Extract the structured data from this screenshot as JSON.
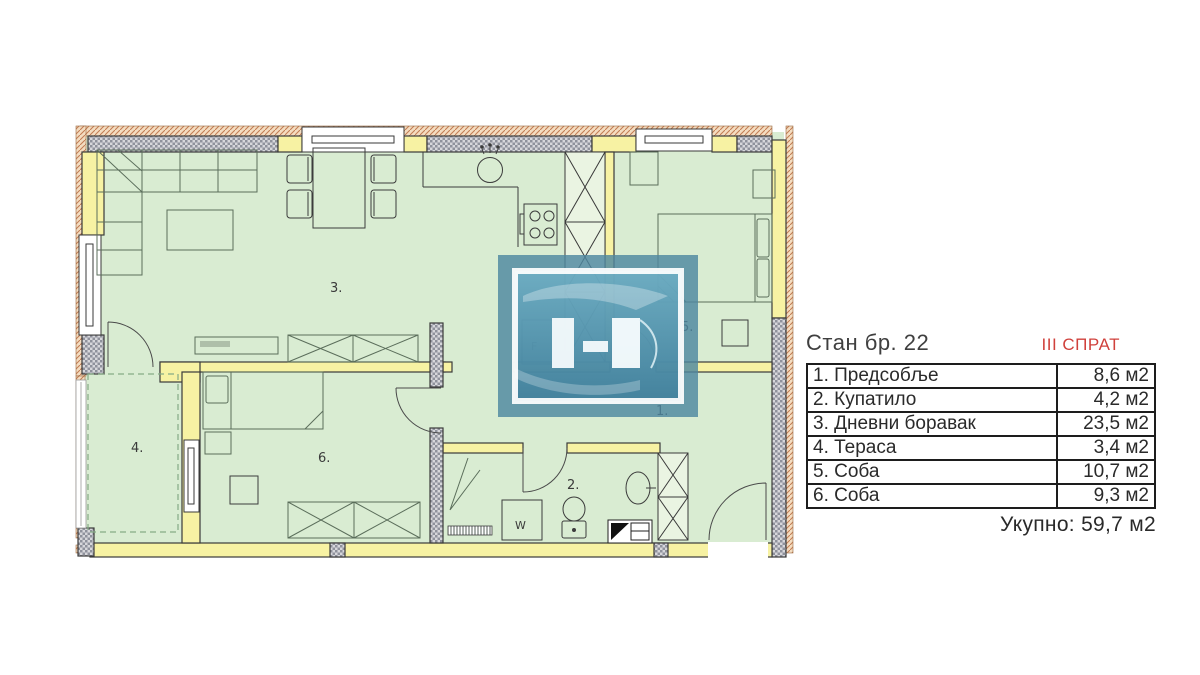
{
  "panel": {
    "title": "Стан бр. 22",
    "floor": "III СПРАТ",
    "table": {
      "rows": [
        {
          "label": "1. Предсобље",
          "area": "8,6 м2"
        },
        {
          "label": "2. Купатило",
          "area": "4,2 м2"
        },
        {
          "label": "3. Дневни боравак",
          "area": "23,5 м2"
        },
        {
          "label": "4. Тераса",
          "area": "3,4 м2"
        },
        {
          "label": "5. Соба",
          "area": "10,7 м2"
        },
        {
          "label": "6. Соба",
          "area": "9,3 м2"
        }
      ]
    },
    "total": "Укупно: 59,7 м2"
  },
  "plan": {
    "labels": {
      "hallway": "1.",
      "bathroom": "2.",
      "living_room": "3.",
      "terrace": "4.",
      "bedroom_1": "5.",
      "bedroom_2": "6.",
      "fridge": "F",
      "washer": "W"
    },
    "colors": {
      "floor_fill": "#d9ecd2",
      "wall_yellow": "#f7f2a3",
      "wall_gray": "#d7d7db",
      "facade_tan": "#f3dcc0",
      "accent_red": "#d0413c",
      "watermark_teal": "#4e87a0"
    }
  }
}
